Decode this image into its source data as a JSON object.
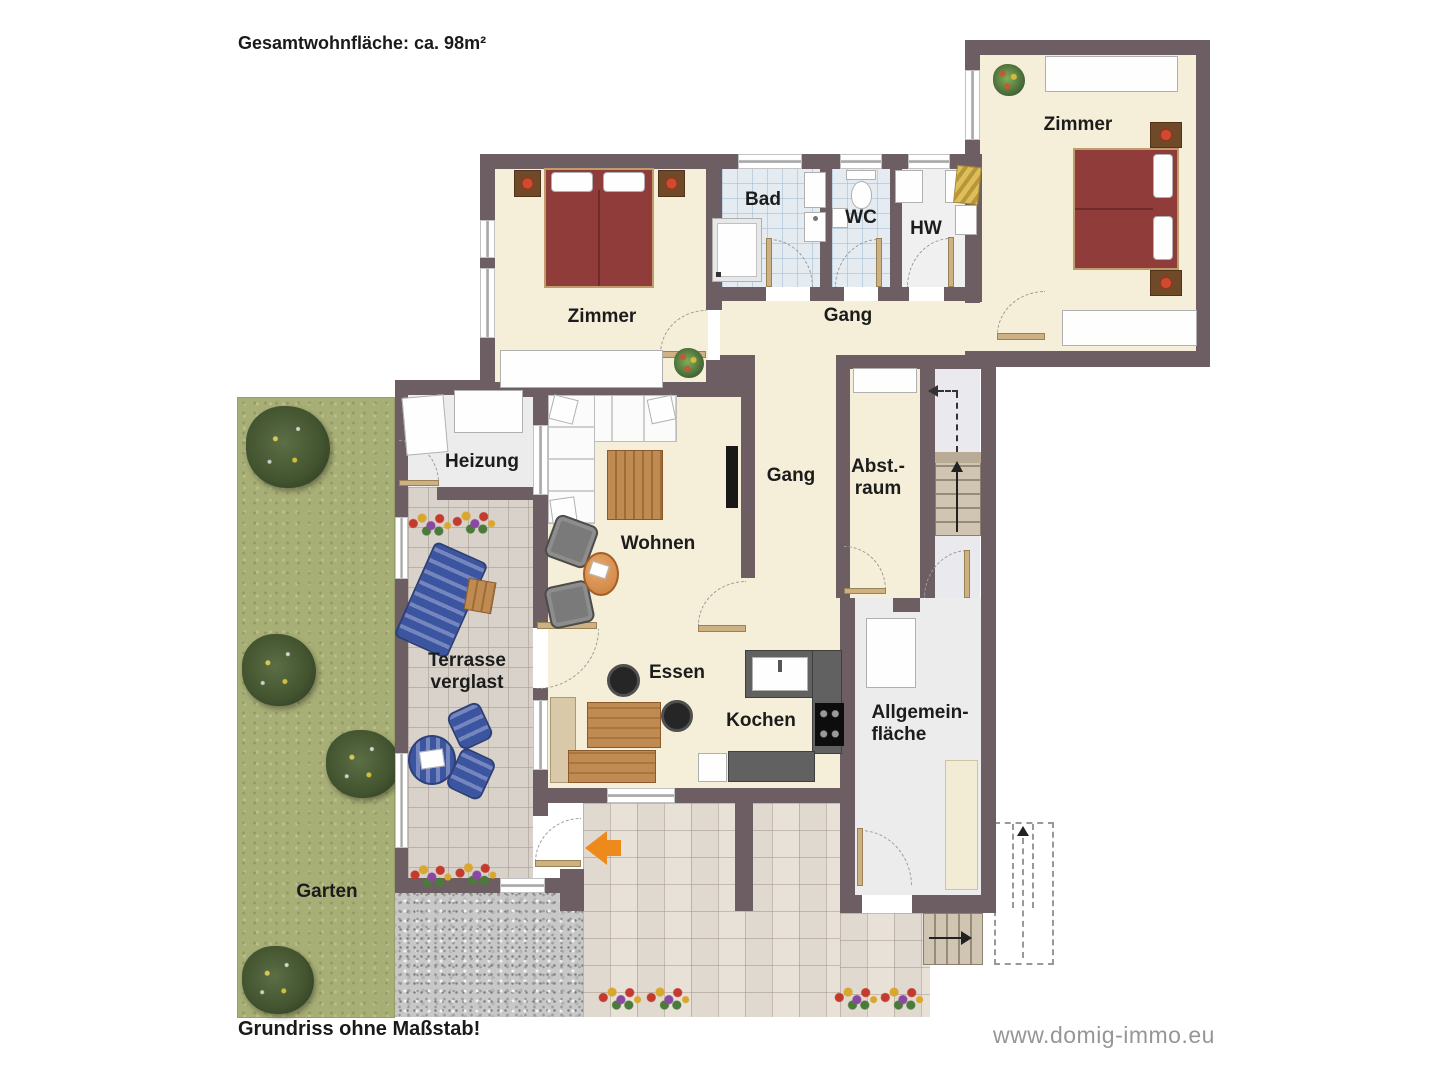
{
  "page": {
    "title": "Gesamtwohnfläche: ca. 98m²",
    "footnote": "Grundriss ohne Maßstab!",
    "website": "www.domig-immo.eu"
  },
  "rooms": {
    "zimmer_left": "Zimmer",
    "zimmer_right": "Zimmer",
    "bad": "Bad",
    "wc": "WC",
    "hw": "HW",
    "gang_upper": "Gang",
    "gang_lower": "Gang",
    "heizung": "Heizung",
    "wohnen": "Wohnen",
    "abstellraum_line1": "Abst.-",
    "abstellraum_line2": "raum",
    "essen": "Essen",
    "kochen": "Kochen",
    "allgemein_line1": "Allgemein-",
    "allgemein_line2": "fläche",
    "terrasse_line1": "Terrasse",
    "terrasse_line2": "verglast",
    "garten": "Garten"
  },
  "icons": {
    "entrance_arrow": "orange-left-arrow",
    "stairs_up_arrow": "black-up-arrow",
    "stairs_exit_arrow": "black-right-arrow"
  },
  "colors": {
    "wall": "#6c5e62",
    "room_floor": "#f5eed8",
    "bath_tile": "#e4ebf1",
    "utility_floor": "#ececec",
    "terrace_tile": "#d8d2ca",
    "patio_tile": "#e8e1d8",
    "garden_green": "#a8af76",
    "gravel_gray": "#c8c8c8",
    "bed_red": "#8f3c3b",
    "furniture_blue": "#3c55a0",
    "wood": "#c08b52",
    "kitchen_counter": "#616161",
    "entrance_arrow_orange": "#ee8a1c"
  }
}
